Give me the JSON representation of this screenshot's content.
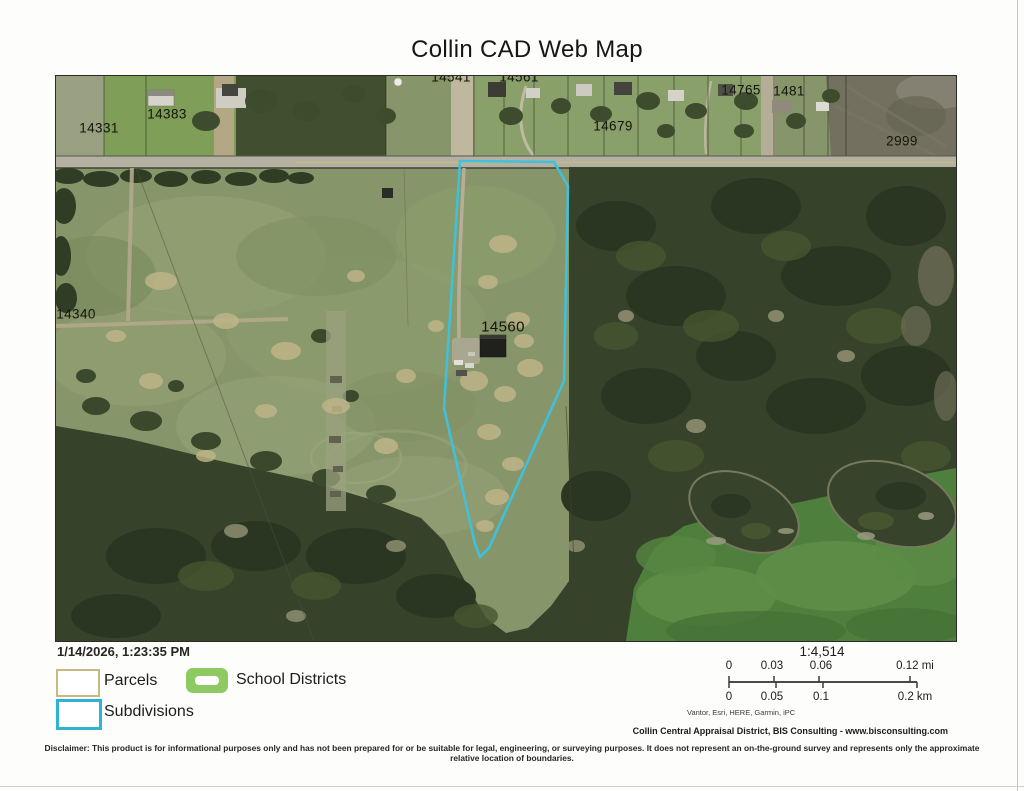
{
  "title": "Collin CAD Web Map",
  "timestamp": "1/14/2026, 1:23:35 PM",
  "legend": {
    "items": [
      {
        "label": "Parcels"
      },
      {
        "label": "School Districts"
      },
      {
        "label": "Subdivisions"
      }
    ]
  },
  "scalebar": {
    "ratio": "1:4,514",
    "mi": [
      "0",
      "0.03",
      "0.06",
      "0.12 mi"
    ],
    "km": [
      "0",
      "0.05",
      "0.1",
      "0.2 km"
    ],
    "attribution": "Vantor, Esri, HERE, Garmin, iPC"
  },
  "credit": "Collin Central Appraisal District, BIS Consulting - www.bisconsulting.com",
  "disclaimer": "Disclaimer: This product is for informational purposes only and has not been prepared for or be suitable for legal, engineering, or surveying purposes. It does not represent an on-the-ground survey and represents only the approximate relative location of boundaries.",
  "map": {
    "highlighted_parcel": "14560",
    "labels": [
      {
        "text": "14331",
        "x": 43,
        "y": 52
      },
      {
        "text": "14383",
        "x": 111,
        "y": 38
      },
      {
        "text": "14541",
        "x": 395,
        "y": 1,
        "clipped": true
      },
      {
        "text": "14561",
        "x": 463,
        "y": 1,
        "clipped": true
      },
      {
        "text": "14679",
        "x": 557,
        "y": 50
      },
      {
        "text": "14765",
        "x": 685,
        "y": 14
      },
      {
        "text": "1481",
        "x": 733,
        "y": 15
      },
      {
        "text": "2999",
        "x": 846,
        "y": 65
      },
      {
        "text": "14340",
        "x": 20,
        "y": 238
      },
      {
        "text": "14560",
        "x": 447,
        "y": 251,
        "highlight": true
      }
    ],
    "colors": {
      "subdivision_outline": "#3ec1dd",
      "parcels_swatch_border": "#c9b87f",
      "school_districts_swatch": "#8fc962",
      "subdivisions_swatch_border": "#2fb3d2"
    }
  }
}
